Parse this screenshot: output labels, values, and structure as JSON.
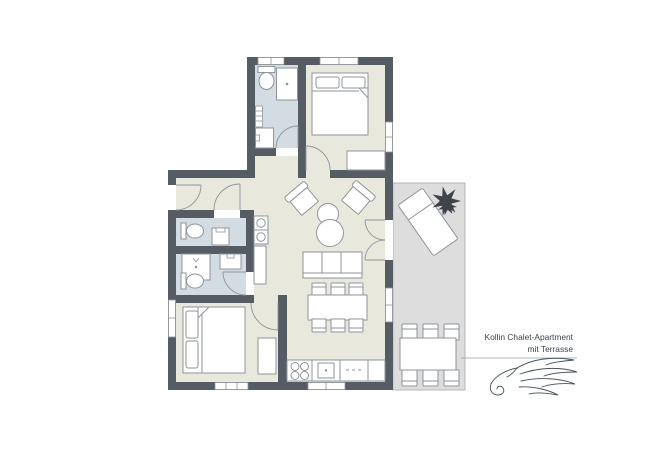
{
  "title": {
    "line1": "Kollin Chalet-Apartment",
    "line2": "mit Terrasse"
  },
  "colors": {
    "wall": "#565c64",
    "floor": "#e9e8dd",
    "wet_floor": "#d4dce3",
    "terrace_floor": "#dcdddc",
    "terrace_border": "#b5b7b7",
    "furniture_stroke": "#8f959a",
    "door_arc": "#8f959a",
    "plant": "#3f444b",
    "title_text": "#3d444b",
    "logo_stroke": "#46525c",
    "divider_line": "#9aa0a5",
    "background": "#ffffff"
  },
  "floorplan": {
    "rooms": [
      {
        "name": "bathroom-top",
        "floor": "wet",
        "furniture": [
          "toilet",
          "shower",
          "radiator",
          "sink"
        ]
      },
      {
        "name": "bedroom-top",
        "floor": "dry",
        "furniture": [
          "double-bed",
          "wardrobe"
        ]
      },
      {
        "name": "hallway",
        "floor": "dry",
        "furniture": []
      },
      {
        "name": "wc",
        "floor": "wet",
        "furniture": [
          "toilet",
          "washer"
        ]
      },
      {
        "name": "shower-room",
        "floor": "wet",
        "furniture": [
          "shower",
          "sink",
          "toilet"
        ]
      },
      {
        "name": "living-room",
        "floor": "dry",
        "furniture": [
          "armchair",
          "armchair",
          "round-coffee-table",
          "round-coffee-table",
          "sofa",
          "appliance-column",
          "sideboard",
          "dining-table",
          "six-chairs"
        ]
      },
      {
        "name": "kitchen",
        "floor": "dry",
        "furniture": [
          "counter",
          "stove-4-burners",
          "sink",
          "dishwasher"
        ]
      },
      {
        "name": "bedroom-bottom",
        "floor": "dry",
        "furniture": [
          "double-bed",
          "wardrobe"
        ]
      },
      {
        "name": "terrace",
        "floor": "terrace",
        "furniture": [
          "sun-lounger",
          "plant",
          "outdoor-dining-table",
          "six-chairs"
        ]
      }
    ]
  }
}
